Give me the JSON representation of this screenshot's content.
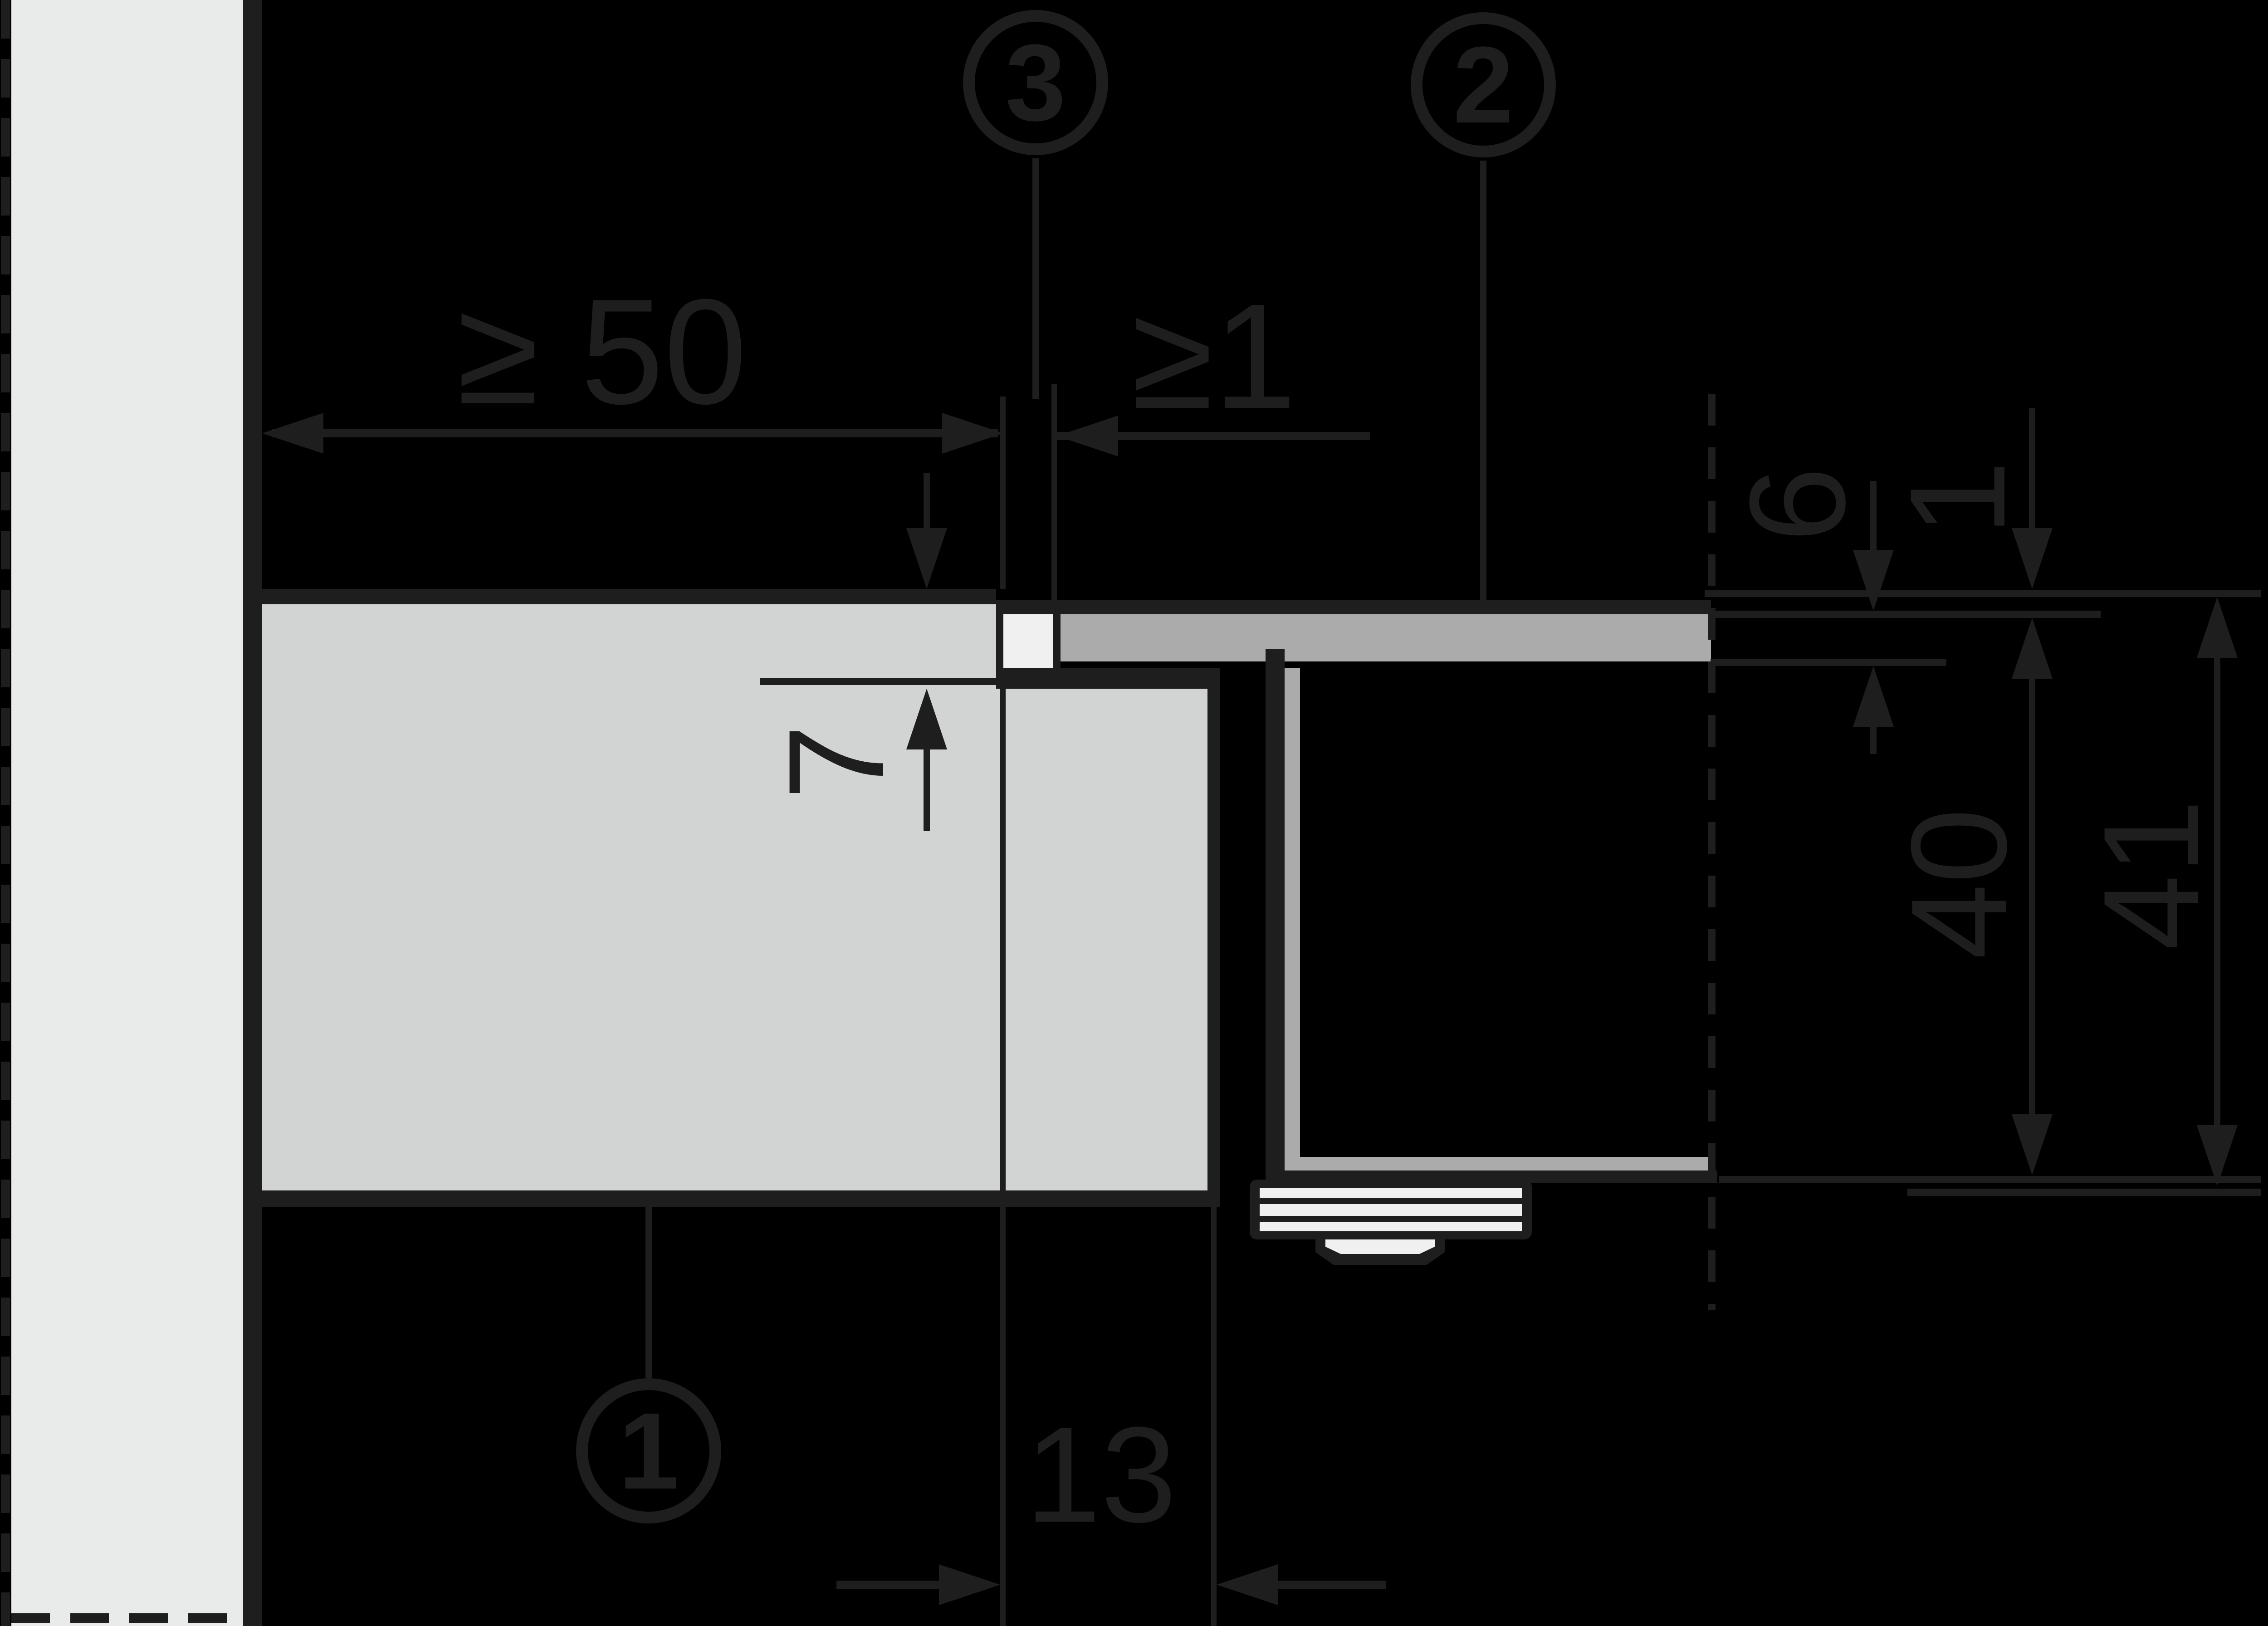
{
  "drawing": {
    "type": "installation-cross-section-diagram",
    "background": "#000000",
    "colors": {
      "line": "#1e1e1e",
      "wall": "#e9eaea",
      "worktop": "#d2d3d3",
      "appliance_frame": "#ababab",
      "white_parts": "#f0f0f0"
    },
    "callouts": {
      "c1": {
        "label": "1"
      },
      "c2": {
        "label": "2"
      },
      "c3": {
        "label": "3"
      }
    },
    "dimensions": {
      "side_clearance": "≥ 50",
      "front_clearance": "≥1",
      "rabbet_depth": "7",
      "frame_thickness": "6",
      "frame_offset": "1",
      "depth_below_frame": "40",
      "depth_below_worktop": "41",
      "rabbet_width": "13"
    }
  }
}
